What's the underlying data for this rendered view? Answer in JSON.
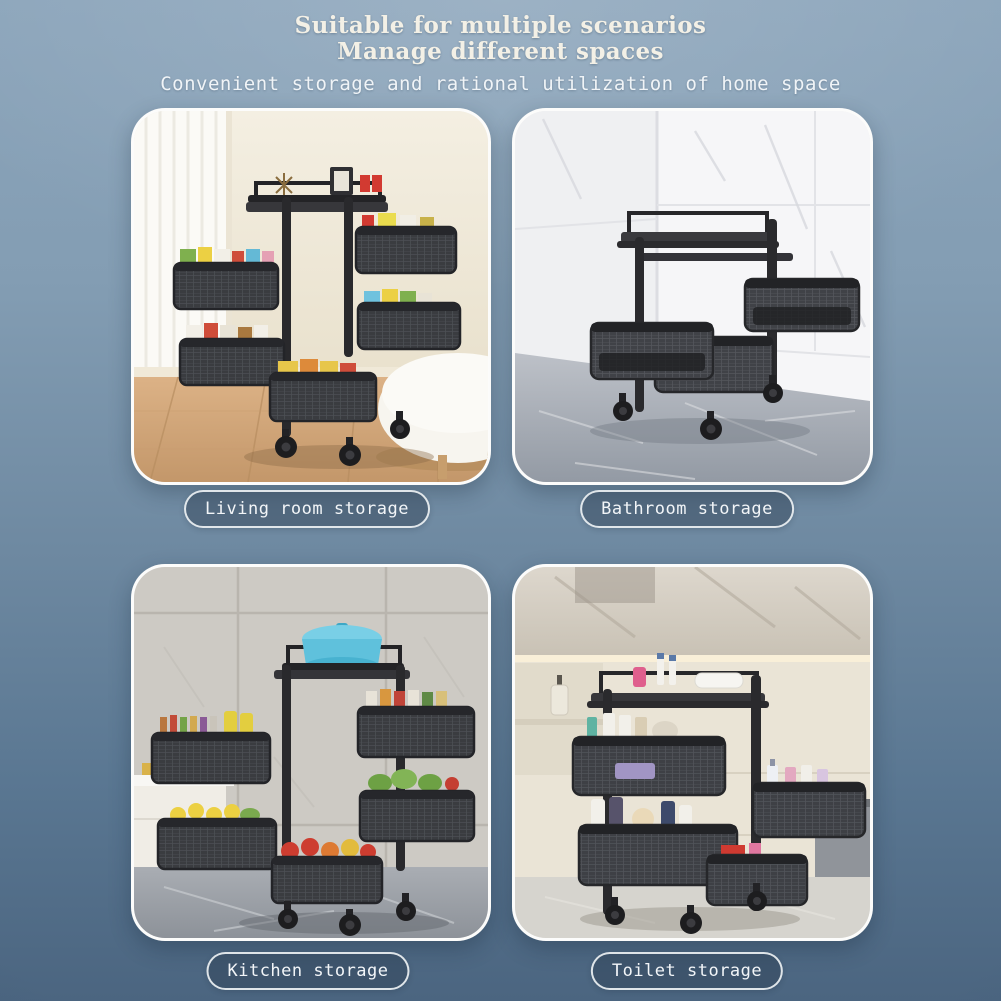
{
  "header": {
    "title_line1": "Suitable for multiple scenarios",
    "title_line2": "Manage different spaces",
    "subtitle": "Convenient storage and rational utilization of home space"
  },
  "scenes": [
    {
      "id": "living-room",
      "label": "Living room storage",
      "photo_description": "Black 5-tier rotating square basket cart filled with colorful snacks beside a white curtain, cream wall, wood floor and white ottoman"
    },
    {
      "id": "bathroom",
      "label": "Bathroom storage",
      "photo_description": "Empty black 3-tier rotating basket cart with swiveled baskets in a white marble tiled corner with gray marble floor"
    },
    {
      "id": "kitchen",
      "label": "Kitchen storage",
      "photo_description": "Black 5-tier rotating cart with blue pot on top, baskets of spice bottles, lemons, greens and tomatoes against gray tiled wall with white counter"
    },
    {
      "id": "toilet",
      "label": "Toilet storage",
      "photo_description": "Black rotating cart holding toiletries, shampoo bottles and a towel under a marble vanity wall with beige cabinets"
    }
  ],
  "colors": {
    "background_top": "#8ca5bb",
    "background_bottom": "#4b6580",
    "title_text": "#f3f0e6",
    "subtitle_text": "#f0f4f7",
    "pill_background": "rgba(44,61,82,0.45)",
    "pill_border": "#f6f9fb",
    "pill_text": "#f2f5f8",
    "cart_frame": "#29292c"
  }
}
